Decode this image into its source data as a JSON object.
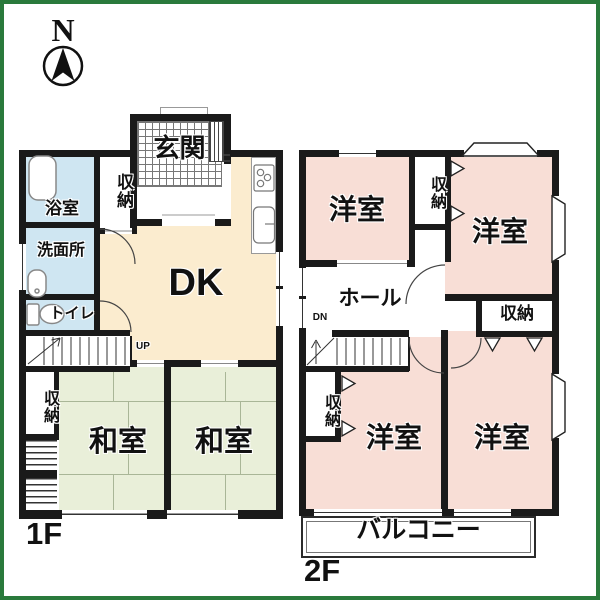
{
  "compass": {
    "label": "N"
  },
  "colors": {
    "wall": "#1a1a1a",
    "frame_green": "#2a7a3c",
    "room_pink": "#f8ded6",
    "room_green": "#e9efd9",
    "room_cream": "#fbeccf",
    "room_blue": "#cfe6f2"
  },
  "floor1": {
    "label": "1F",
    "genkan": "玄関",
    "closet_top": "収納",
    "bath": "浴室",
    "washroom": "洗面所",
    "toilet": "トイレ",
    "dk": "DK",
    "stairs_up": "UP",
    "closet_bottom": "収納",
    "washitsu_left": "和室",
    "washitsu_right": "和室"
  },
  "floor2": {
    "label": "2F",
    "yoshitsu_top_left": "洋室",
    "closet_top": "収納",
    "yoshitsu_top_right": "洋室",
    "hall": "ホール",
    "stairs_down": "DN",
    "closet_right": "収納",
    "closet_bottom_left": "収納",
    "yoshitsu_bottom_left": "洋室",
    "yoshitsu_bottom_right": "洋室",
    "balcony": "バルコニー"
  }
}
